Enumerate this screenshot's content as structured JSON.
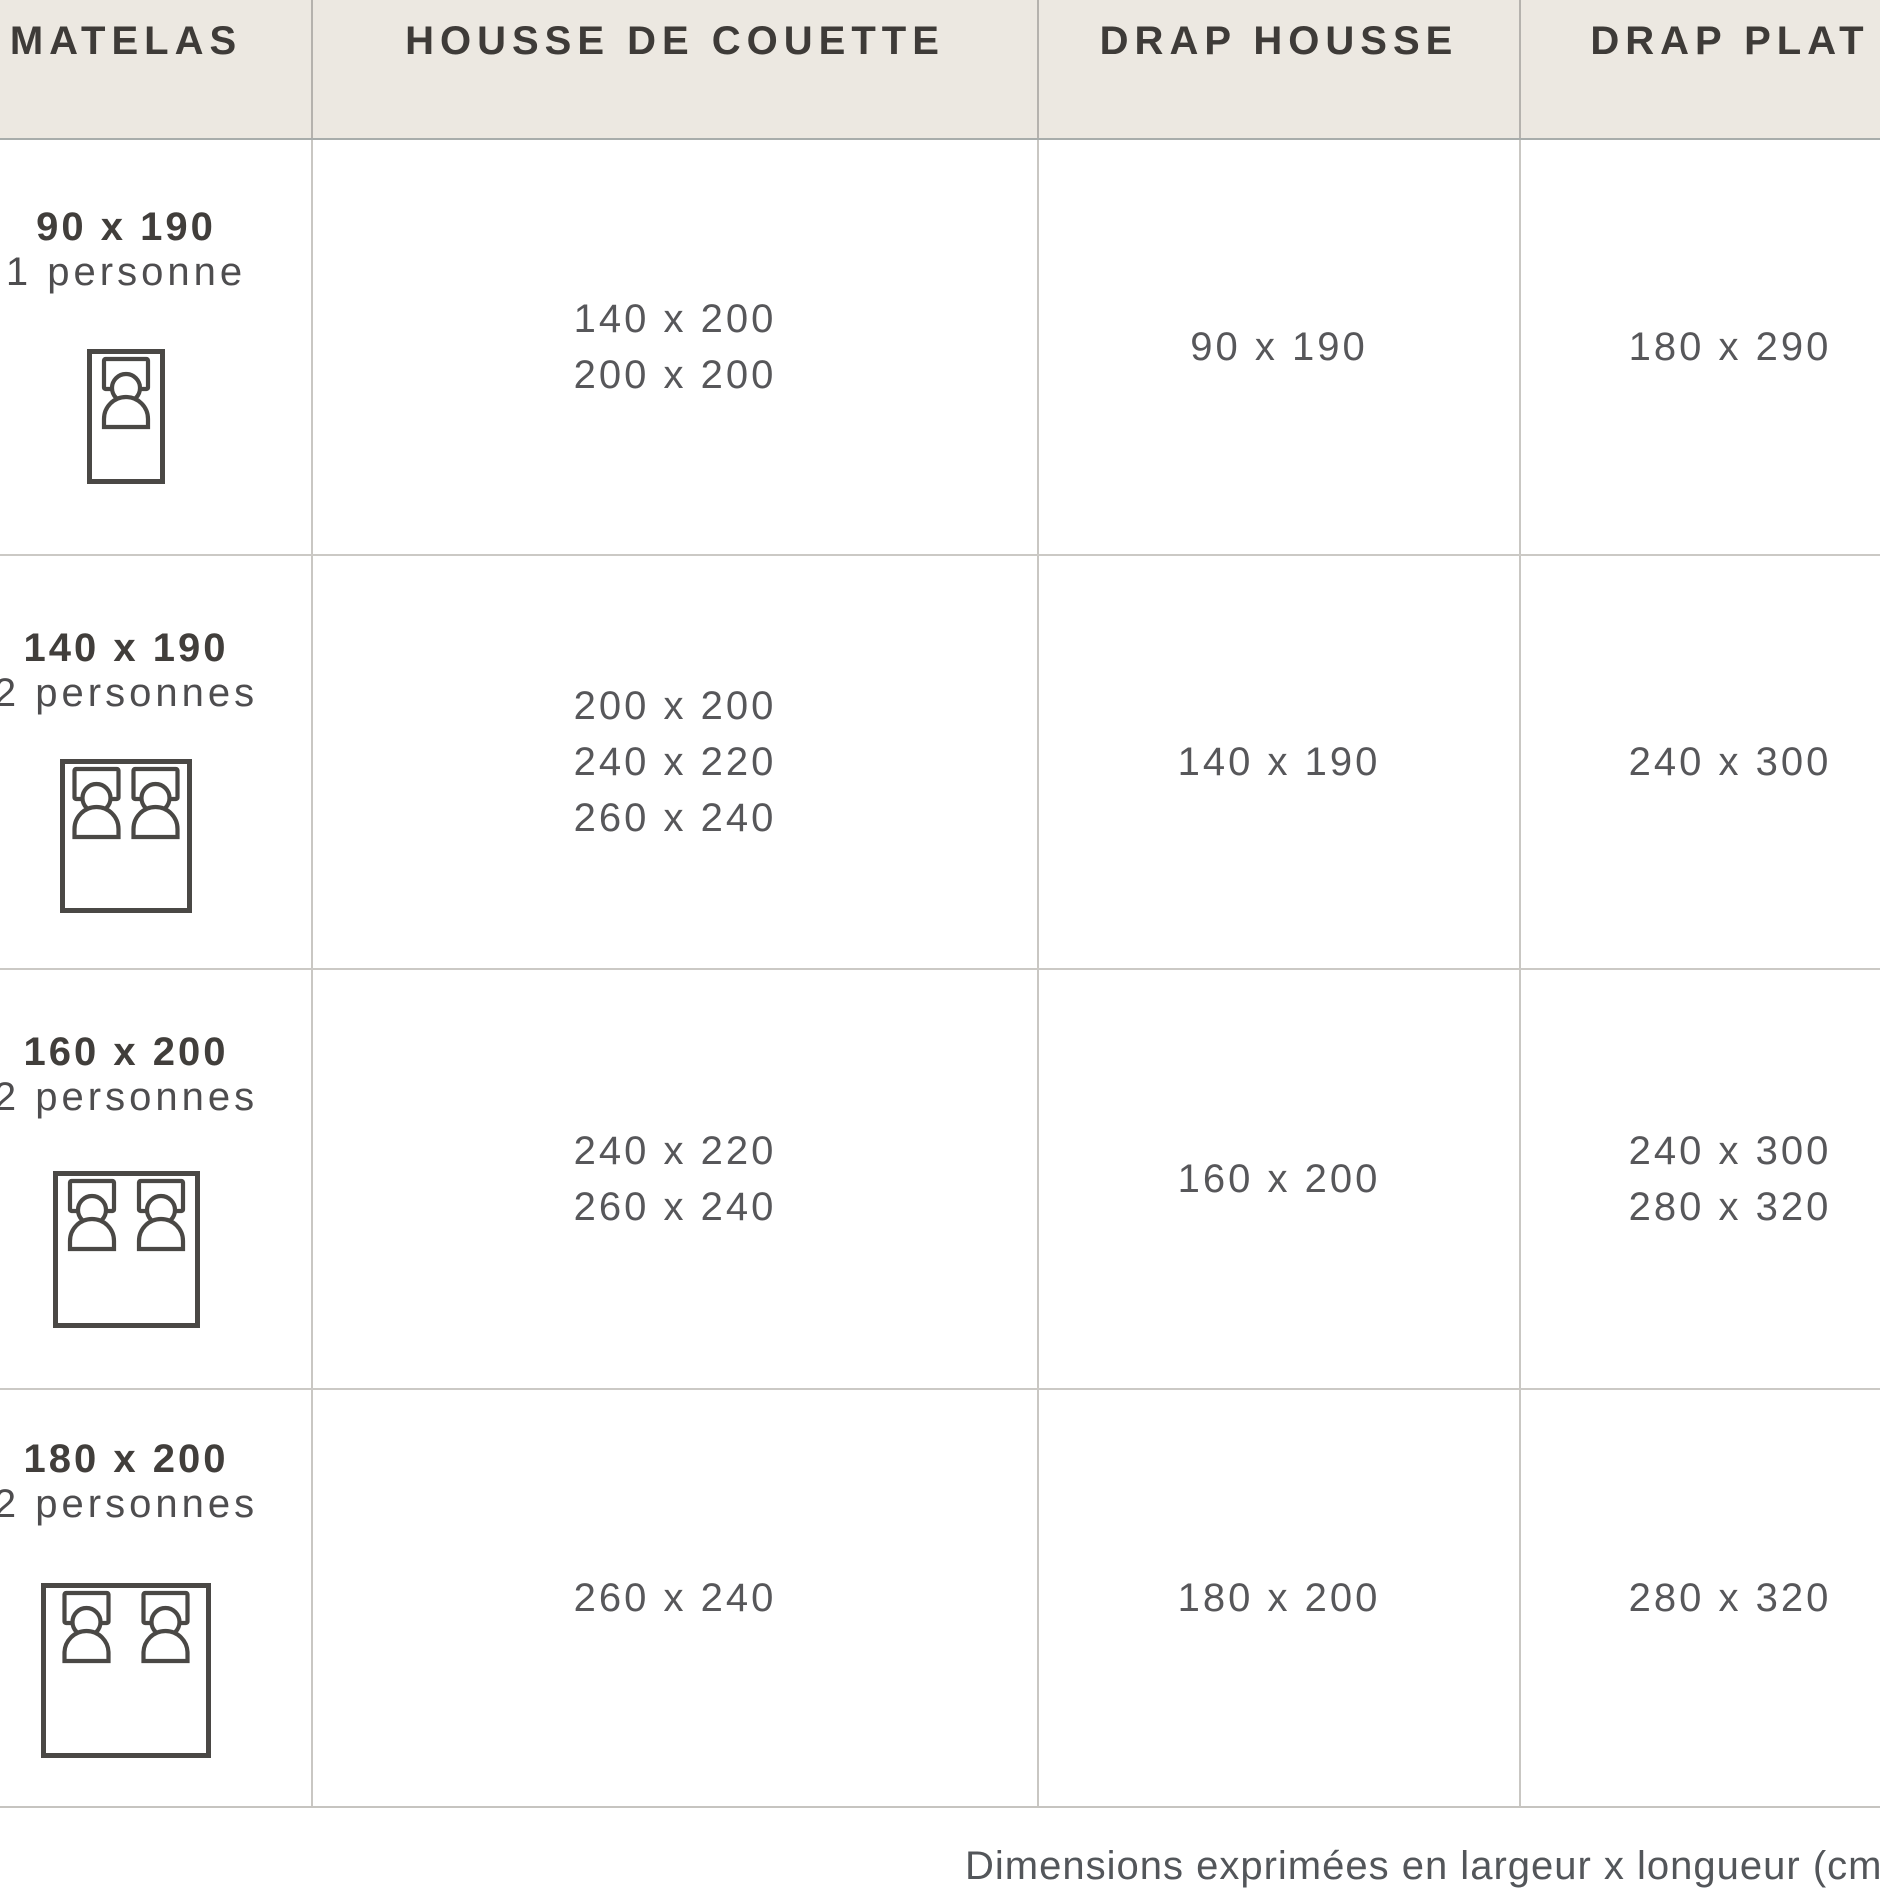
{
  "table": {
    "columns": [
      {
        "id": "matelas",
        "label": "MATELAS"
      },
      {
        "id": "housse_de_couette",
        "label": "HOUSSE DE COUETTE"
      },
      {
        "id": "drap_housse",
        "label": "DRAP HOUSSE"
      },
      {
        "id": "drap_plat",
        "label": "DRAP PLAT"
      }
    ],
    "rows": [
      {
        "mattress_size": "90 x 190",
        "capacity": "1 personne",
        "icon": "bed-single-icon",
        "housse_de_couette": [
          "140 x 200",
          "200 x 200"
        ],
        "drap_housse": [
          "90 x 190"
        ],
        "drap_plat": [
          "180 x 290"
        ]
      },
      {
        "mattress_size": "140 x 190",
        "capacity": "2 personnes",
        "icon": "bed-double-icon",
        "housse_de_couette": [
          "200 x 200",
          "240 x 220",
          "260 x 240"
        ],
        "drap_housse": [
          "140 x 190"
        ],
        "drap_plat": [
          "240 x 300"
        ]
      },
      {
        "mattress_size": "160 x 200",
        "capacity": "2 personnes",
        "icon": "bed-double-icon",
        "housse_de_couette": [
          "240 x 220",
          "260 x 240"
        ],
        "drap_housse": [
          "160 x 200"
        ],
        "drap_plat": [
          "240 x 300",
          "280 x 320"
        ]
      },
      {
        "mattress_size": "180 x 200",
        "capacity": "2 personnes",
        "icon": "bed-double-icon",
        "housse_de_couette": [
          "260 x 240"
        ],
        "drap_housse": [
          "180 x 200"
        ],
        "drap_plat": [
          "280 x 320"
        ]
      }
    ]
  },
  "footnote": "Dimensions exprimées en largeur x longueur (cm)",
  "colors": {
    "header_bg": "#ECE8E1",
    "header_text": "#3E3B38",
    "title_text": "#413E3B",
    "value_text": "#57575A",
    "icon_stroke": "#4A4845",
    "grid_line": "#C9C7C3"
  }
}
